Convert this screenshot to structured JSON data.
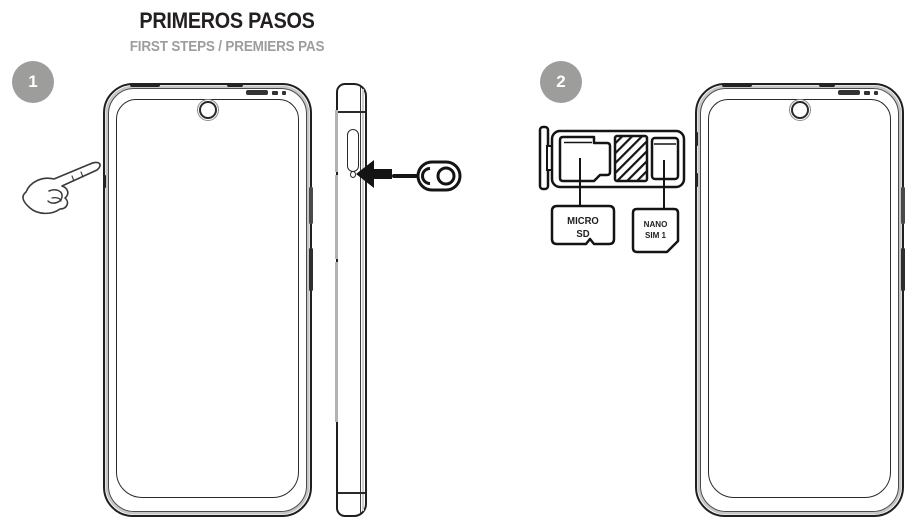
{
  "header": {
    "title": "PRIMEROS PASOS",
    "subtitle": "FIRST STEPS / PREMIERS PAS"
  },
  "steps": [
    {
      "number": "1"
    },
    {
      "number": "2"
    }
  ],
  "tray": {
    "micro_sd": {
      "line1": "MICRO",
      "line2": "SD"
    },
    "nano_sim": {
      "line1": "NANO",
      "line2": "SIM 1"
    }
  },
  "icons": {
    "hand": "pointing-hand-icon",
    "arrow": "arrow-left-icon",
    "eject_tool": "sim-eject-tool-icon",
    "micro_sd_card": "micro-sd-card-icon",
    "nano_sim_card": "nano-sim-card-icon"
  },
  "colors": {
    "line": "#1f1f20",
    "badge_gray": "#9d9d9c",
    "subtitle_gray": "#9d9d9c",
    "frame_gray": "#c6c6c6"
  }
}
